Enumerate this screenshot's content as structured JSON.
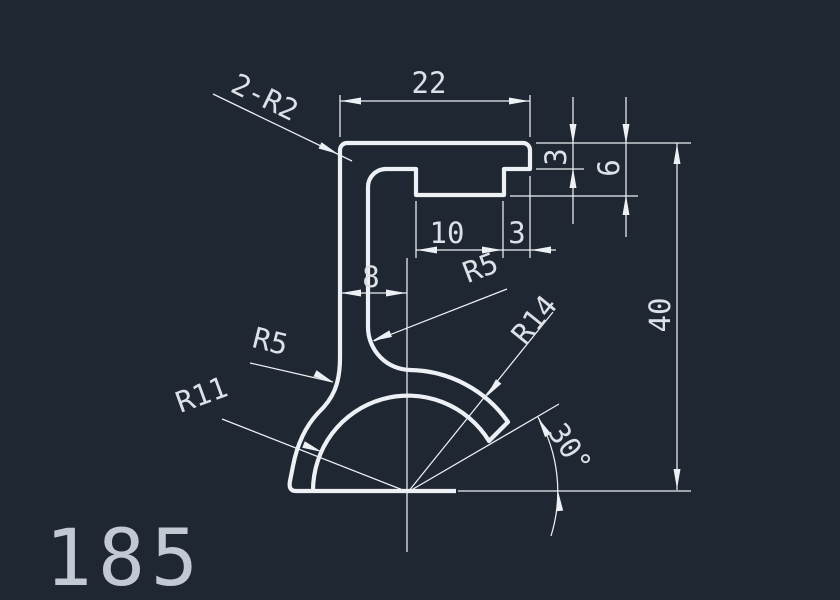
{
  "canvas": {
    "colors": {
      "bg": "#1f2732",
      "line": "#edf0f4",
      "text": "#dde1e7",
      "title": "#c3c9d3"
    }
  },
  "labels": {
    "top_width": "22",
    "flange_thickness": "3",
    "rib_depth": "6",
    "rib_width": "10",
    "rib_to_edge": "3",
    "web_offset": "8",
    "total_height": "40",
    "angle": "30°",
    "corner_radius": "2-R2",
    "web_inner_radius": "R5",
    "foot_radius": "R5",
    "hook_outer_radius": "R14",
    "hook_inner_radius": "R11",
    "part_number": "185"
  }
}
